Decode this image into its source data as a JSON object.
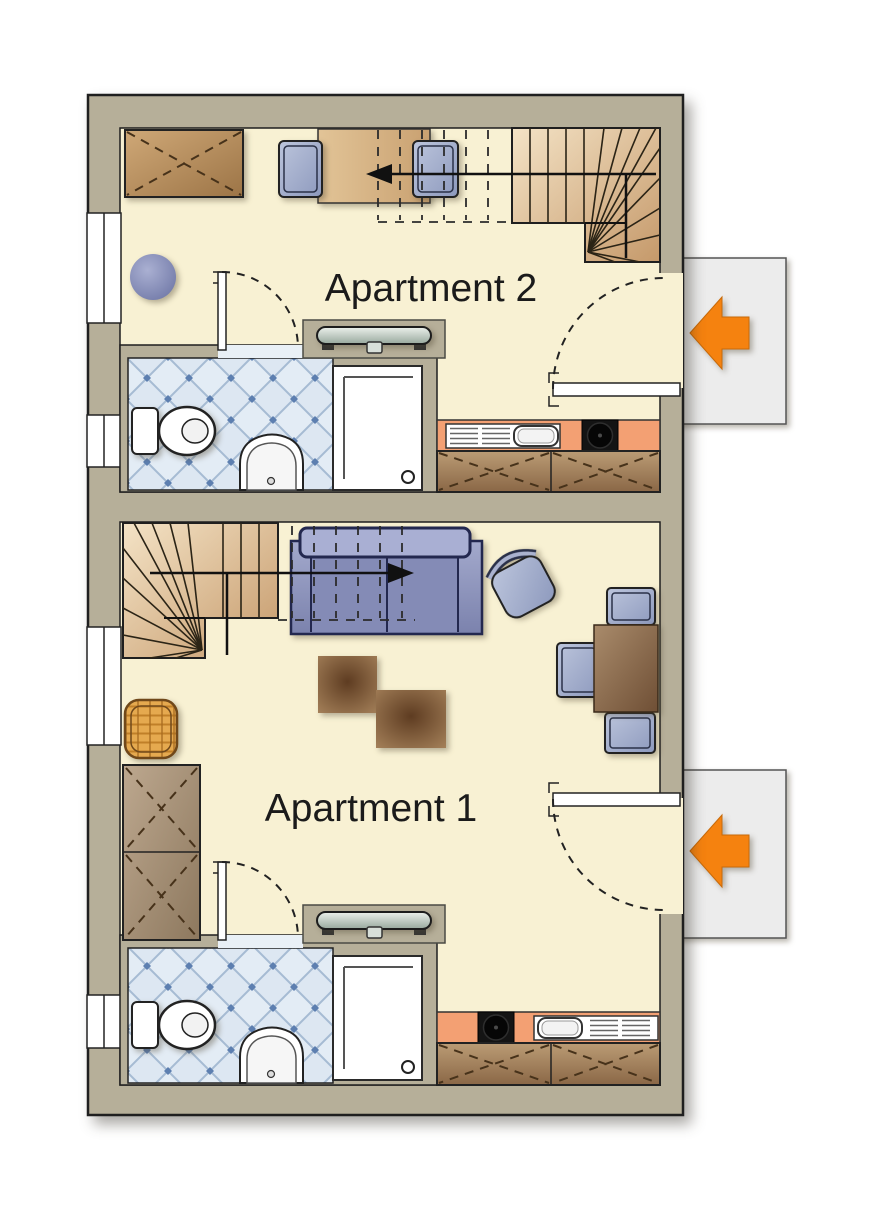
{
  "page": {
    "background": "#ffffff",
    "description": "Two-apartment architectural floor plan"
  },
  "labels": {
    "apartment1": "Apartment 1",
    "apartment2": "Apartment 2"
  },
  "colors": {
    "wall": "#b6af99",
    "floor": "#f8f1d3",
    "landing": "#ececec",
    "arrow": "#f5820f",
    "label": "#1b1b1b",
    "counter": "#f3a073",
    "tile_bg": "#e3ecf5",
    "tile_accent": "#5d7fb0",
    "cabinet": "#a3845f",
    "stair": "#dfc49c",
    "sofa": "#8f96c0",
    "chair": "#aeb8d3",
    "wood": "#8a6746",
    "basket": "#e5a94f",
    "radiator": "#c9d4cc",
    "cooktop": "#141414",
    "outline": "#1f1f1f"
  },
  "apartments": [
    {
      "id": "apartment2",
      "label": "Apartment 2",
      "position": "upper",
      "entrance_arrow": "left",
      "items": [
        "staircase",
        "stair-direction-arrow",
        "desk-with-two-chairs",
        "sideboard",
        "round-table",
        "radiator",
        "toilet",
        "washbasin",
        "shower",
        "kitchen-sink",
        "cooktop",
        "kitchen-cabinets",
        "entrance-door",
        "bathroom-door",
        "windows"
      ]
    },
    {
      "id": "apartment1",
      "label": "Apartment 1",
      "position": "lower",
      "entrance_arrow": "left",
      "items": [
        "staircase",
        "stair-direction-arrow",
        "sofa-bed",
        "coffee-tables",
        "armchair",
        "dining-table-with-three-chairs",
        "wardrobe",
        "laundry-basket",
        "radiator",
        "toilet",
        "washbasin",
        "shower",
        "kitchen-sink",
        "cooktop",
        "kitchen-cabinets",
        "entrance-door",
        "bathroom-door",
        "windows"
      ]
    }
  ]
}
